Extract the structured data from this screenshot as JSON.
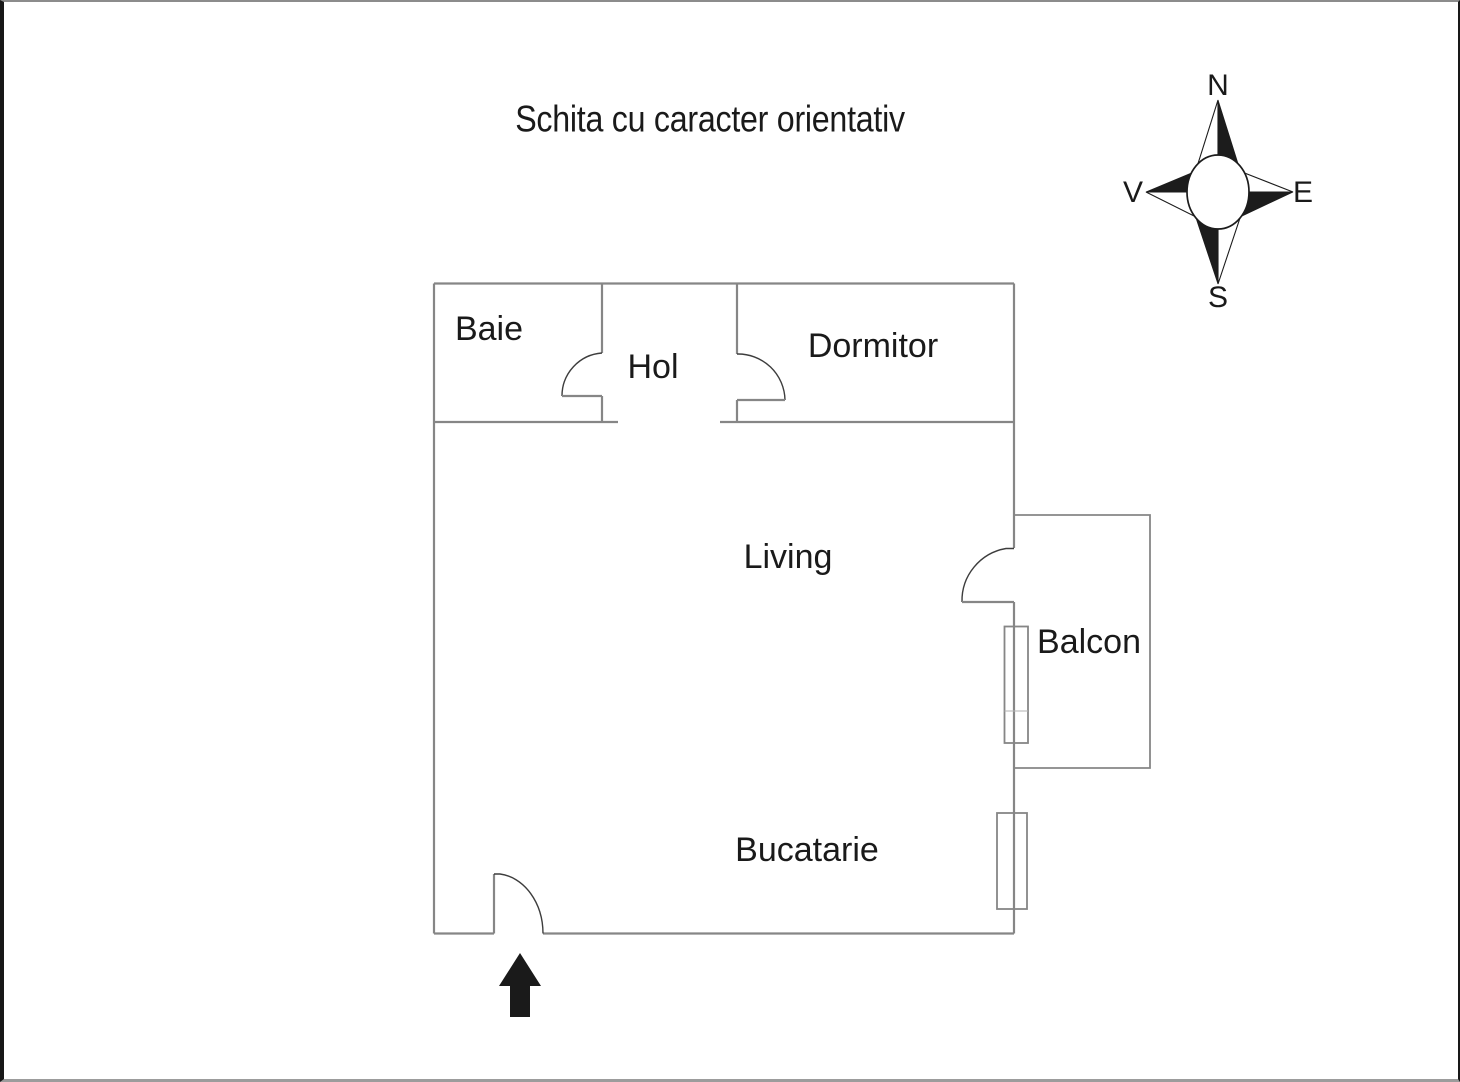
{
  "title": "Schita cu caracter orientativ",
  "rooms": {
    "baie": {
      "label": "Baie"
    },
    "hol": {
      "label": "Hol"
    },
    "dormitor": {
      "label": "Dormitor"
    },
    "living": {
      "label": "Living"
    },
    "balcon": {
      "label": "Balcon"
    },
    "bucatarie": {
      "label": "Bucatarie"
    }
  },
  "compass": {
    "north": "N",
    "east": "E",
    "south": "S",
    "west": "V"
  },
  "icons": {
    "entrance_marker": "entrance-arrow-icon",
    "orientation_marker": "compass-rose-icon"
  },
  "colors": {
    "wall": "#868686",
    "door_line": "#3d3d3d",
    "text": "#1a1a1a",
    "background": "#ffffff",
    "compass_fill": "#1c1c1c"
  }
}
